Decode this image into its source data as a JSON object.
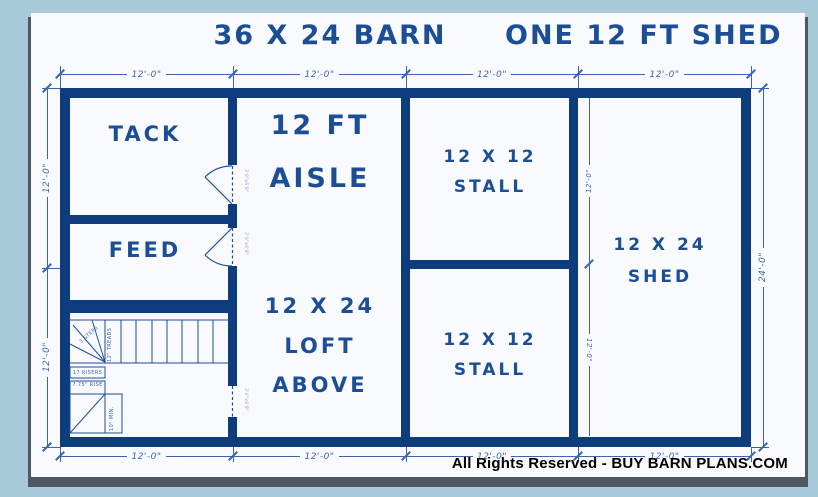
{
  "title": {
    "left": "36 X 24 BARN",
    "right": "ONE 12 FT SHED"
  },
  "rooms": {
    "tack": "TACK",
    "feed": "FEED",
    "aisle": [
      "12 FT",
      "AISLE"
    ],
    "loft": [
      "12 X 24",
      "LOFT",
      "ABOVE"
    ],
    "stall_top": [
      "12 X 12",
      "STALL"
    ],
    "stall_bottom": [
      "12 X 12",
      "STALL"
    ],
    "shed": [
      "12 X 24",
      "SHED"
    ]
  },
  "dimensions": {
    "top": [
      "12'-0\"",
      "12'-0\"",
      "12'-0\"",
      "12'-0\""
    ],
    "bottom": [
      "12'-0\"",
      "12'-0\"",
      "12'-0\"",
      "12'-0\""
    ],
    "left": [
      "12'-0\"",
      "12'-0\""
    ],
    "right_overall": "24'-0\"",
    "shed_interior": [
      "12'-0\"",
      "12'-0\""
    ]
  },
  "stairs": {
    "steps": "3 STEPS",
    "treads": "12\" TREADS",
    "risers": "17 RISERS",
    "rise": "7.75\" RISE",
    "min": "10\" MIN."
  },
  "doors": {
    "tack_size": "3'0\"x6'8\"",
    "feed_size": "3'0\"x6'8\"",
    "aisle_size": "3'0\"x6'8\""
  },
  "footer": "All Rights Reserved - BUY BARN PLANS.COM",
  "colors": {
    "wall": "#0d3d7c",
    "text": "#1c4e95",
    "dimension": "#3a66ad",
    "paper": "#f9fafd",
    "background": "#a7c9d8",
    "footer_text": "#000000"
  }
}
